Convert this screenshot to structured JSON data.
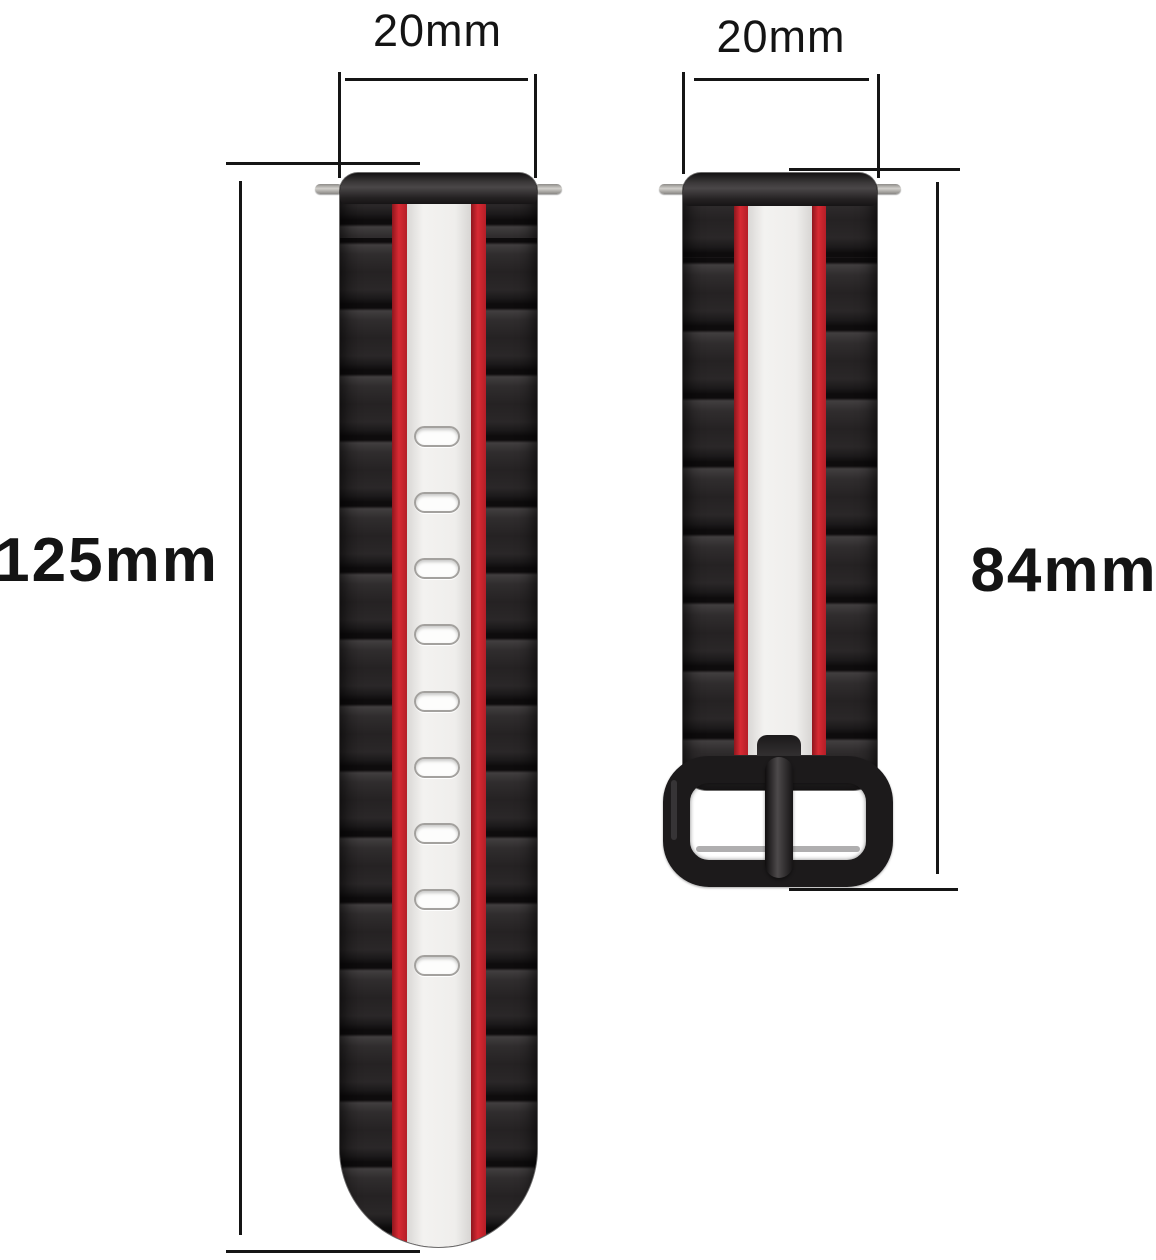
{
  "image": {
    "kind": "product-dimension-diagram",
    "subject": "Two-tone silicone watch band set (long tail strap with holes, short buckle strap) annotated with size measurements",
    "background": "#ffffff"
  },
  "colors": {
    "dimension_line": "#151515",
    "label_text": "#141414",
    "band_black": "#262425",
    "stripe_red": "#c9242e",
    "stripe_white": "#efeeec",
    "buckle_black": "#1c1a1b",
    "spring_bar_grey": "#b5b2af"
  },
  "long_band": {
    "width_label": "20mm",
    "length_label": "125mm",
    "hole_count": 9
  },
  "short_band": {
    "width_label": "20mm",
    "length_label": "84mm"
  }
}
